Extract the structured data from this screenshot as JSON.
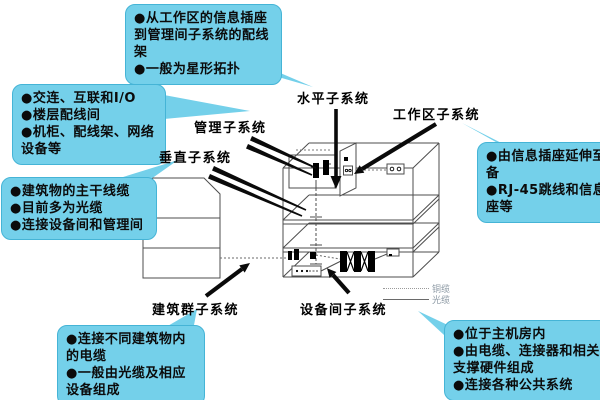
{
  "labels": {
    "horizontal": "水平子系统",
    "work_area": "工作区子系统",
    "management": "管理子系统",
    "backbone": "垂直子系统",
    "campus": "建筑群子系统",
    "equipment_room": "设备间子系统"
  },
  "callouts": {
    "horizontal": {
      "items": [
        "●从工作区的信息插座到管理间子系统的配线架",
        "●一般为星形拓扑"
      ]
    },
    "management": {
      "items": [
        "●交连、互联和I/O",
        "●楼层配线间",
        "●机柜、配线架、网络设备等"
      ]
    },
    "backbone": {
      "items": [
        "●建筑物的主干线缆",
        "●目前多为光缆",
        "●连接设备间和管理间"
      ]
    },
    "work_area": {
      "items": [
        "●由信息插座延伸至设备",
        "●RJ-45跳线和信息插座等"
      ]
    },
    "campus": {
      "items": [
        "●连接不同建筑物内的电缆",
        "●一般由光缆及相应设备组成"
      ]
    },
    "equipment_room": {
      "items": [
        "●位于主机房内",
        "●由电缆、连接器和相关支撑硬件组成",
        "●连接各种公共系统"
      ]
    }
  },
  "legend": {
    "copper_label": "铜缆",
    "fiber_label": "光缆"
  },
  "colors": {
    "callout_fill": "#74d0ea",
    "callout_border": "#45b4d6",
    "diagram_line": "#4d4d4d",
    "arrow": "#0a0a0a",
    "legend_text": "#8c99a4"
  }
}
